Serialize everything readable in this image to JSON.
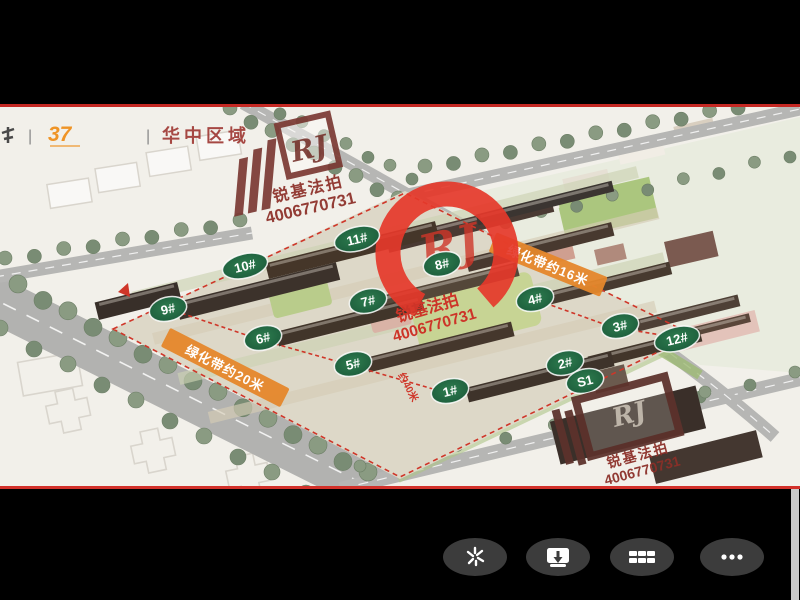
{
  "viewer": {
    "background_color": "#000000",
    "separator_color": "#c42823"
  },
  "header_watermark": {
    "brand_number": "37",
    "divider": "|",
    "region_label": "华中区域"
  },
  "brand": {
    "logo_text": "RJ",
    "name": "锐基法拍",
    "phone": "4006770731",
    "stamp_color": "#e5382a",
    "maroon_color": "#7c3b35"
  },
  "site_plan": {
    "label_color": "#1e5f3e",
    "banner_color": "#e5872b",
    "building_labels": [
      {
        "id": "11#",
        "x": 357,
        "y": 132
      },
      {
        "id": "10#",
        "x": 245,
        "y": 159
      },
      {
        "id": "8#",
        "x": 442,
        "y": 157
      },
      {
        "id": "9#",
        "x": 168,
        "y": 202
      },
      {
        "id": "7#",
        "x": 368,
        "y": 194
      },
      {
        "id": "4#",
        "x": 535,
        "y": 192
      },
      {
        "id": "6#",
        "x": 263,
        "y": 231
      },
      {
        "id": "5#",
        "x": 353,
        "y": 257
      },
      {
        "id": "3#",
        "x": 620,
        "y": 219
      },
      {
        "id": "12#",
        "x": 677,
        "y": 232
      },
      {
        "id": "2#",
        "x": 565,
        "y": 256
      },
      {
        "id": "S1",
        "x": 585,
        "y": 274
      },
      {
        "id": "1#",
        "x": 450,
        "y": 284
      }
    ],
    "banners": [
      {
        "text": "绿化带约20米",
        "x": 225,
        "y": 261,
        "angle": 27,
        "w": 134
      },
      {
        "text": "绿化带约16米",
        "x": 548,
        "y": 158,
        "angle": 22,
        "w": 120
      }
    ],
    "measurements": [
      {
        "text": "约40米",
        "x": 398,
        "y": 268,
        "angle": 62
      }
    ]
  },
  "toolbar": {
    "button_color": "#3c3c3c",
    "buttons": [
      {
        "name": "sparkle"
      },
      {
        "name": "download"
      },
      {
        "name": "grid-view"
      },
      {
        "name": "more"
      }
    ]
  }
}
